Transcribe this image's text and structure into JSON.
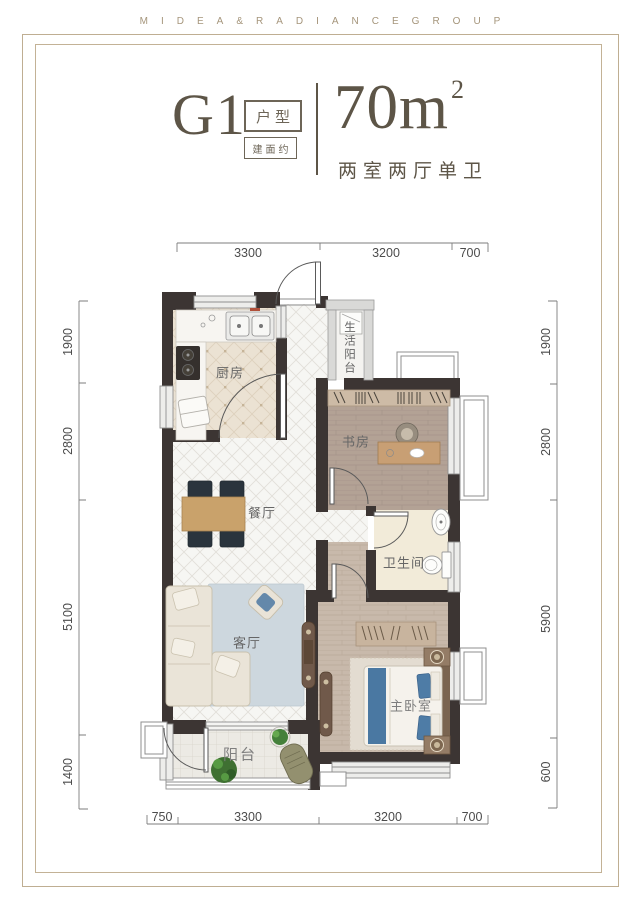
{
  "letterhead": "MIDEA&RADIANCEGROUP",
  "title": {
    "code": "G1",
    "code_tag": "户型",
    "area_tag": "建面约",
    "area_value": "70m",
    "area_sup": "2",
    "subtitle": "两室两厅单卫"
  },
  "rooms": {
    "kitchen": "厨房",
    "utility_balcony": "生活阳台",
    "study": "书房",
    "dining": "餐厅",
    "bathroom": "卫生间",
    "living": "客厅",
    "master_bedroom": "主卧室",
    "balcony": "阳台"
  },
  "dims": {
    "top": [
      "3300",
      "3200",
      "700"
    ],
    "bottom": [
      "750",
      "3300",
      "3200",
      "700"
    ],
    "left": [
      "1900",
      "2800",
      "5100",
      "1400"
    ],
    "right": [
      "1900",
      "2800",
      "5900",
      "600"
    ]
  },
  "colors": {
    "frame": "#bfae92",
    "letterhead_text": "#a5957b",
    "title_text": "#5d5547",
    "wall": "#3c3533",
    "window": "#ededeb",
    "kitchen_floor": "#ebe2d3",
    "wood_study": "#b3a295",
    "wood_bedroom": "#c8b9ab",
    "bath_floor": "#f2ebd9",
    "rug_living": "#cdd7de",
    "bed_accent": "#4a78a2",
    "dining_table": "#c9a26b"
  }
}
